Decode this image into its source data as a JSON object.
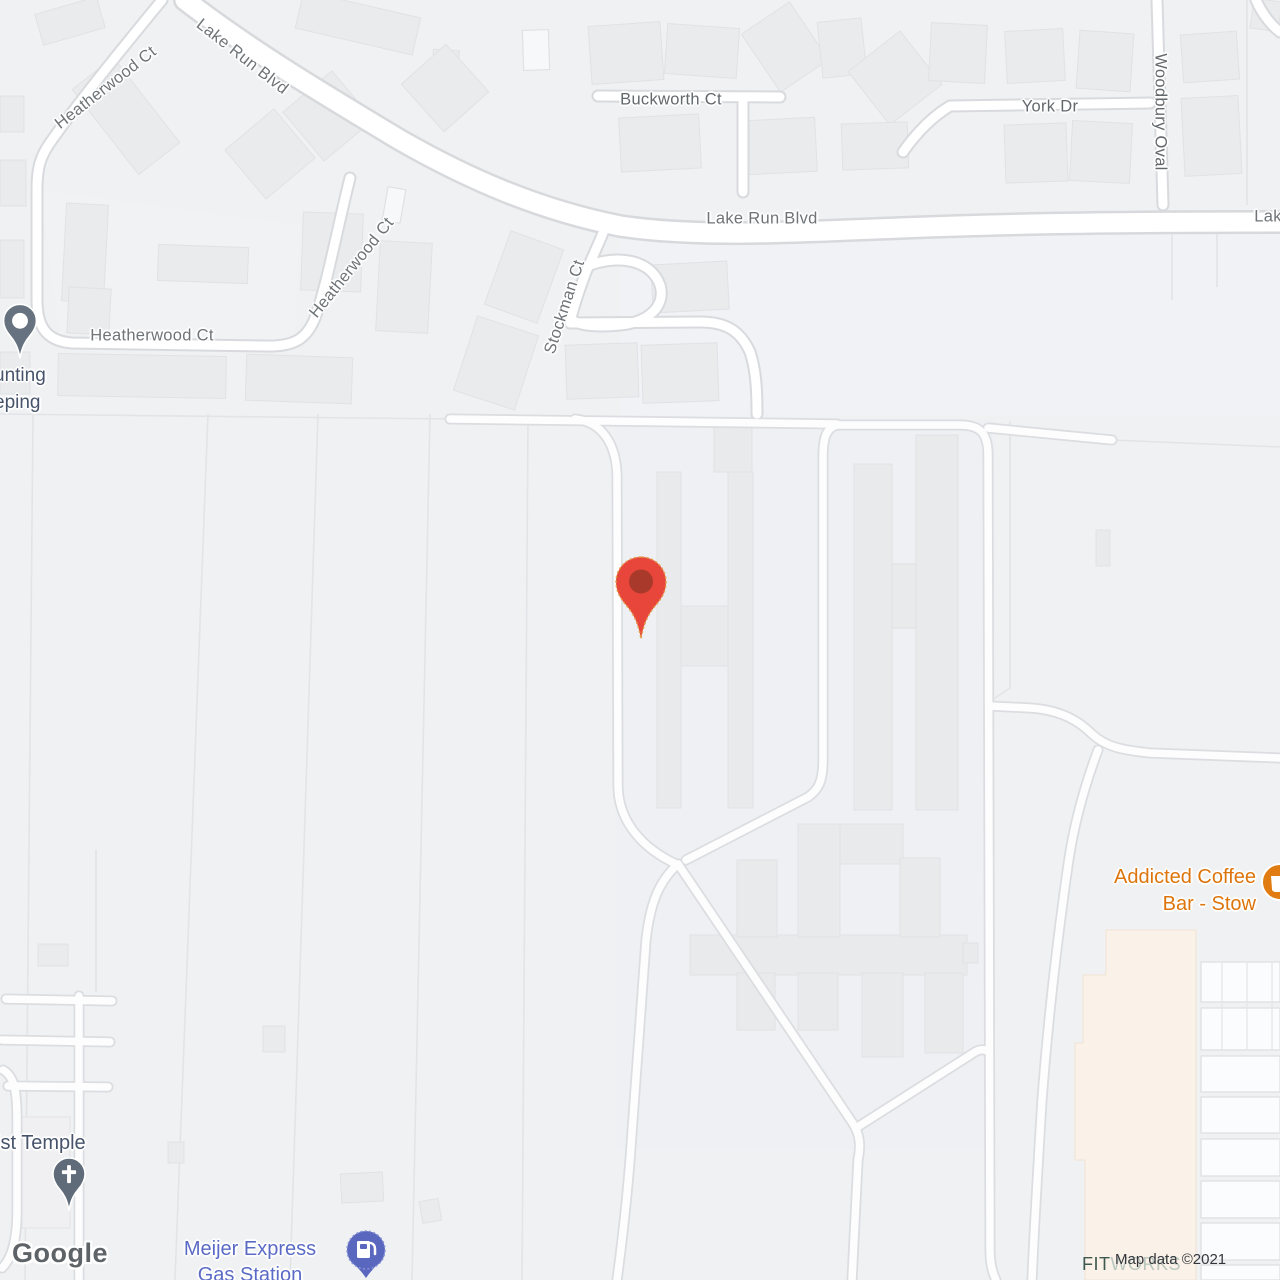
{
  "roads": {
    "heatherwood_nw": "Heatherwood Ct",
    "lake_run_diag": "Lake Run Blvd",
    "buckworth": "Buckworth Ct",
    "york": "York Dr",
    "woodbury": "Woodbury Oval",
    "lake_run_mid": "Lake Run Blvd",
    "lake_run_cut": "Lak",
    "heatherwood_ne": "Heatherwood Ct",
    "stockman": "Stockman Ct",
    "heatherwood_s": "Heatherwood Ct"
  },
  "pois": {
    "accounting": {
      "line1": "unting",
      "line2": "eping",
      "color": "#46536a"
    },
    "temple": {
      "name": "ist Temple",
      "color": "#46536a"
    },
    "coffee": {
      "line1": "Addicted Coffee",
      "line2": "Bar - Stow",
      "color": "#dd750c"
    },
    "gas": {
      "line1": "Meijer Express",
      "line2": "Gas Station",
      "color": "#5b6bc5"
    },
    "fitworks": {
      "part1": "FIT",
      "part2": "WORKS"
    }
  },
  "markers": {
    "destination": {
      "color": "#e8463a",
      "inner": "#a93a2b"
    },
    "business_pin": {
      "color": "#66727f"
    },
    "church_pin": {
      "color": "#5f6b79"
    },
    "gas_pin": {
      "color": "#5a67be"
    },
    "coffee_badge": {
      "color": "#e07c12"
    }
  },
  "watermark": {
    "text": "Google"
  },
  "attribution": {
    "text": "Map data ©2021"
  }
}
